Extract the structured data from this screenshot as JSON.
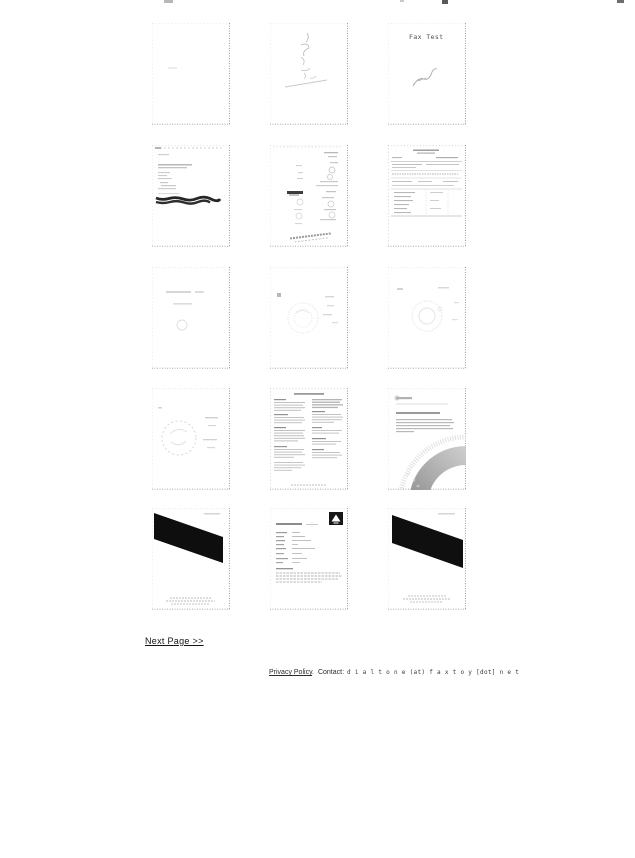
{
  "page": {
    "background": "#ffffff"
  },
  "gallery": {
    "columns": 3,
    "rows": 5,
    "thumbnails": [
      {
        "kind": "blank-page"
      },
      {
        "kind": "handwritten-scrawl"
      },
      {
        "kind": "fax-test-page",
        "text": "Fax Test"
      },
      {
        "kind": "letter-with-redacted-line"
      },
      {
        "kind": "handwritten-list"
      },
      {
        "kind": "form-document"
      },
      {
        "kind": "faint-text-page"
      },
      {
        "kind": "faint-seal-page"
      },
      {
        "kind": "faint-seal-page"
      },
      {
        "kind": "faint-circle-sketch"
      },
      {
        "kind": "two-column-document"
      },
      {
        "kind": "letter-with-arc-graphic"
      },
      {
        "kind": "black-diagonal-band-page"
      },
      {
        "kind": "cover-sheet-with-logo"
      },
      {
        "kind": "black-diagonal-band-page"
      }
    ]
  },
  "pagination": {
    "next_page_label": "Next Page >>"
  },
  "footer": {
    "privacy_link": "Privacy Policy",
    "separator": ".",
    "contact_label": "Contact:",
    "contact_value": "d i a l t o n e (at) f a x t o y [dot] n e t"
  }
}
